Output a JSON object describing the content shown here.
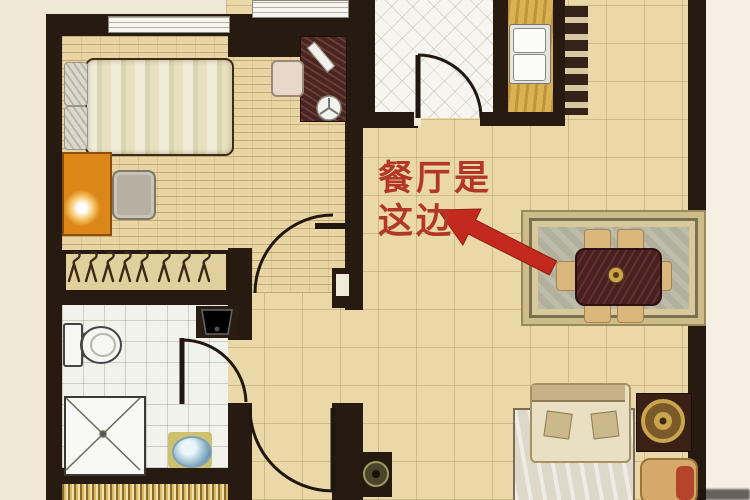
{
  "annotation": {
    "line1": "餐厅是",
    "line2": "这边",
    "text_color": "#b2372a",
    "arrow_color": "#c3291c"
  },
  "palette": {
    "wall": "#271a10",
    "margin": "#f1e9d8",
    "hall_dining_floor": "#ead8a8",
    "bedroom_floor": "#e9d5a3",
    "bathroom_floor": "#f2f2ec",
    "kitchen_floor": "#f6f5f0",
    "counter": "#d9b254",
    "nightstand_orange": "#dd8718",
    "dining_table": "#4a1f20",
    "rug_border": "#cdbb8a",
    "sofa": "#cfc098"
  }
}
